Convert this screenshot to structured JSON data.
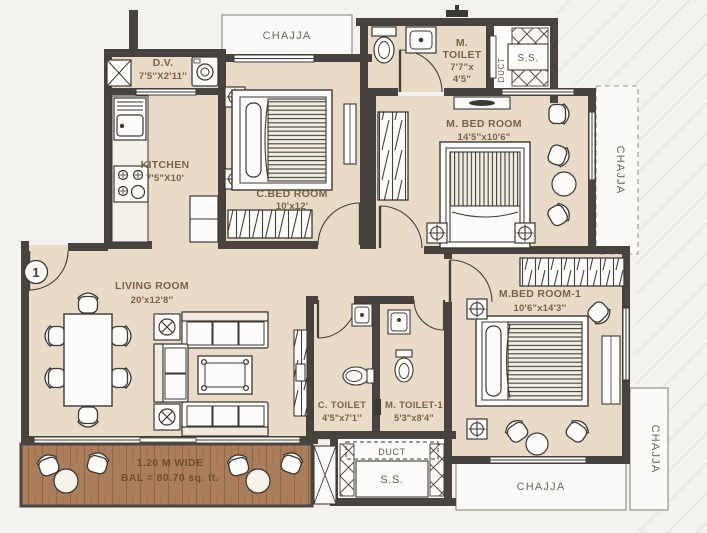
{
  "plan": {
    "rooms": {
      "living": {
        "name": "LIVING ROOM",
        "dims": "20'x12'8''"
      },
      "kitchen": {
        "name": "KITCHEN",
        "dims": "7'5\"X10'"
      },
      "dv": {
        "name": "D.V.",
        "dims": "7'5''X2'11''"
      },
      "c_bedroom": {
        "name": "C.BED ROOM",
        "dims": "10'x12'"
      },
      "m_bedroom": {
        "name": "M. BED ROOM",
        "dims": "14'5''x10'6\""
      },
      "m_bedroom1": {
        "name": "M.BED ROOM-1",
        "dims": "10'6\"x14'3''"
      },
      "m_toilet": {
        "l1": "M.",
        "l2": "TOILET",
        "l3": "7'7\"x",
        "l4": "4'5\""
      },
      "c_toilet": {
        "name": "C. TOILET",
        "dims": "4'5\"x7'1''"
      },
      "m_toilet1": {
        "name": "M. TOILET-1",
        "dims": "5'3\"x8'4\""
      },
      "balcony": {
        "line1": "1.20 M WIDE",
        "line2": "BAL = 80.70 sq. ft."
      }
    },
    "labels": {
      "chajja": "CHAJJA",
      "duct": "DUCT",
      "ss": "S.S.",
      "entry_marker": "1"
    },
    "colors": {
      "wall": "#48433f",
      "floor": "#e9dbc7",
      "balcony_floor": "#aa7e5b",
      "background": "#f4f2ee",
      "label": "#7d6246",
      "line": "#3c3835",
      "white": "#fdfcfa"
    }
  }
}
